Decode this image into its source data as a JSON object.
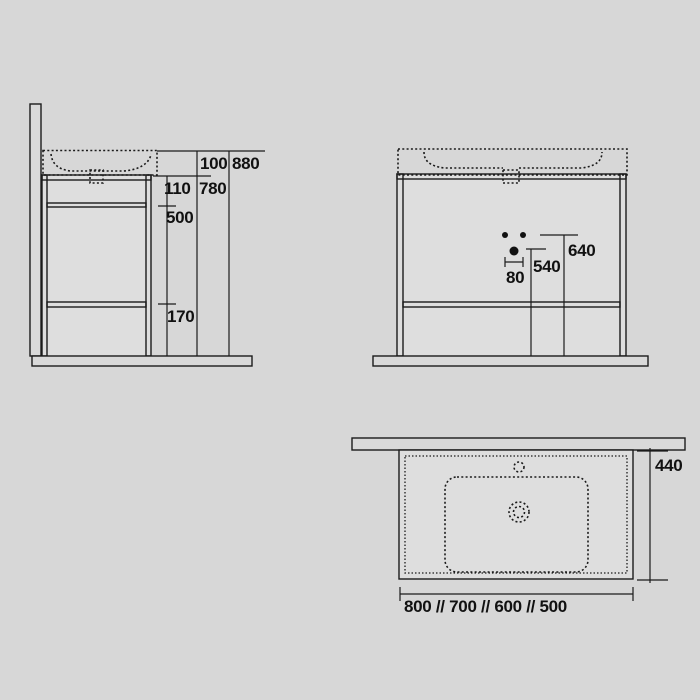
{
  "drawing": {
    "background_color": "#d7d7d7",
    "line_color": "#1b1b1b",
    "views": {
      "side": {
        "dims": {
          "basin_height": "100",
          "total_height": "880",
          "top_rail_section": "110",
          "frame_height": "780",
          "mid_section": "500",
          "bottom_section": "170"
        }
      },
      "front": {
        "dims": {
          "tap_spacing": "80",
          "drain_height": "540",
          "tap_height": "640"
        }
      },
      "top": {
        "dims": {
          "depth": "440",
          "width_options": "800 // 700 // 600 // 500"
        }
      }
    }
  }
}
